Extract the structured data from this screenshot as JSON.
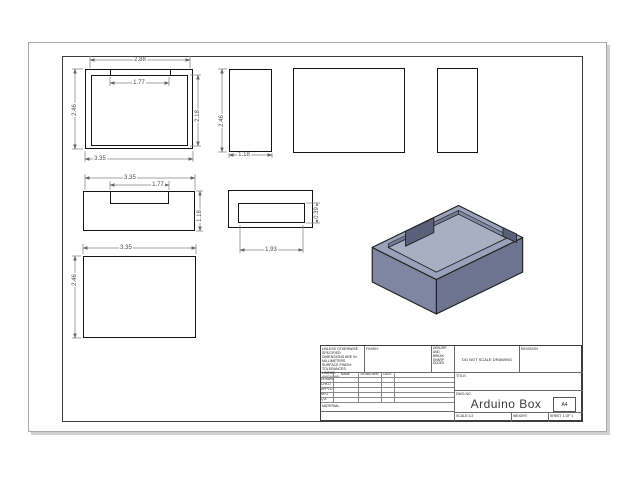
{
  "dimensions": {
    "top_view": {
      "width": "2.88",
      "opening": "1.77",
      "height": "2.46",
      "inner_height": "2.18",
      "base_width": "3.35"
    },
    "left_view": {
      "height": "2.46",
      "width": "1.18"
    },
    "front_view": {
      "width": "3.35",
      "notch_width": "1.77",
      "height": "1.18"
    },
    "cutout_view": {
      "width": "1.93",
      "height": "0.39"
    },
    "bottom_view": {
      "width": "3.35",
      "height": "2.46"
    }
  },
  "title_block": {
    "title": "Arduino Box",
    "sheet_size": "A4",
    "title_label": "TITLE:",
    "dwg_no_label": "DWG NO.",
    "revision_label": "REVISION",
    "do_not_scale": "DO NOT SCALE DRAWING",
    "finish_label": "FINISH:",
    "deburr_note": [
      "DEBURR AND",
      "BREAK SHARP",
      "EDGES"
    ],
    "spec_notes": [
      "UNLESS OTHERWISE SPECIFIED:",
      "DIMENSIONS ARE IN MILLIMETERS",
      "SURFACE FINISH:",
      "TOLERANCES:",
      "LINEAR:",
      "ANGULAR:"
    ],
    "material_label": "MATERIAL:",
    "weight_label": "WEIGHT:",
    "scale_label": "SCALE:1:2",
    "sheet_label": "SHEET 1 OF 1",
    "approval_table": {
      "columns": [
        "NAME",
        "SIGNATURE",
        "DATE"
      ],
      "rows": [
        "DRAWN",
        "CHK'D",
        "APPV'D",
        "MFG",
        "Q.A"
      ]
    }
  },
  "colors": {
    "iso_top": "#9aa2bb",
    "iso_left": "#7e86a0",
    "iso_right": "#6d7490",
    "iso_floor": "#a9afc2",
    "edge": "#1f1f1f",
    "dimension_line": "#858585"
  }
}
